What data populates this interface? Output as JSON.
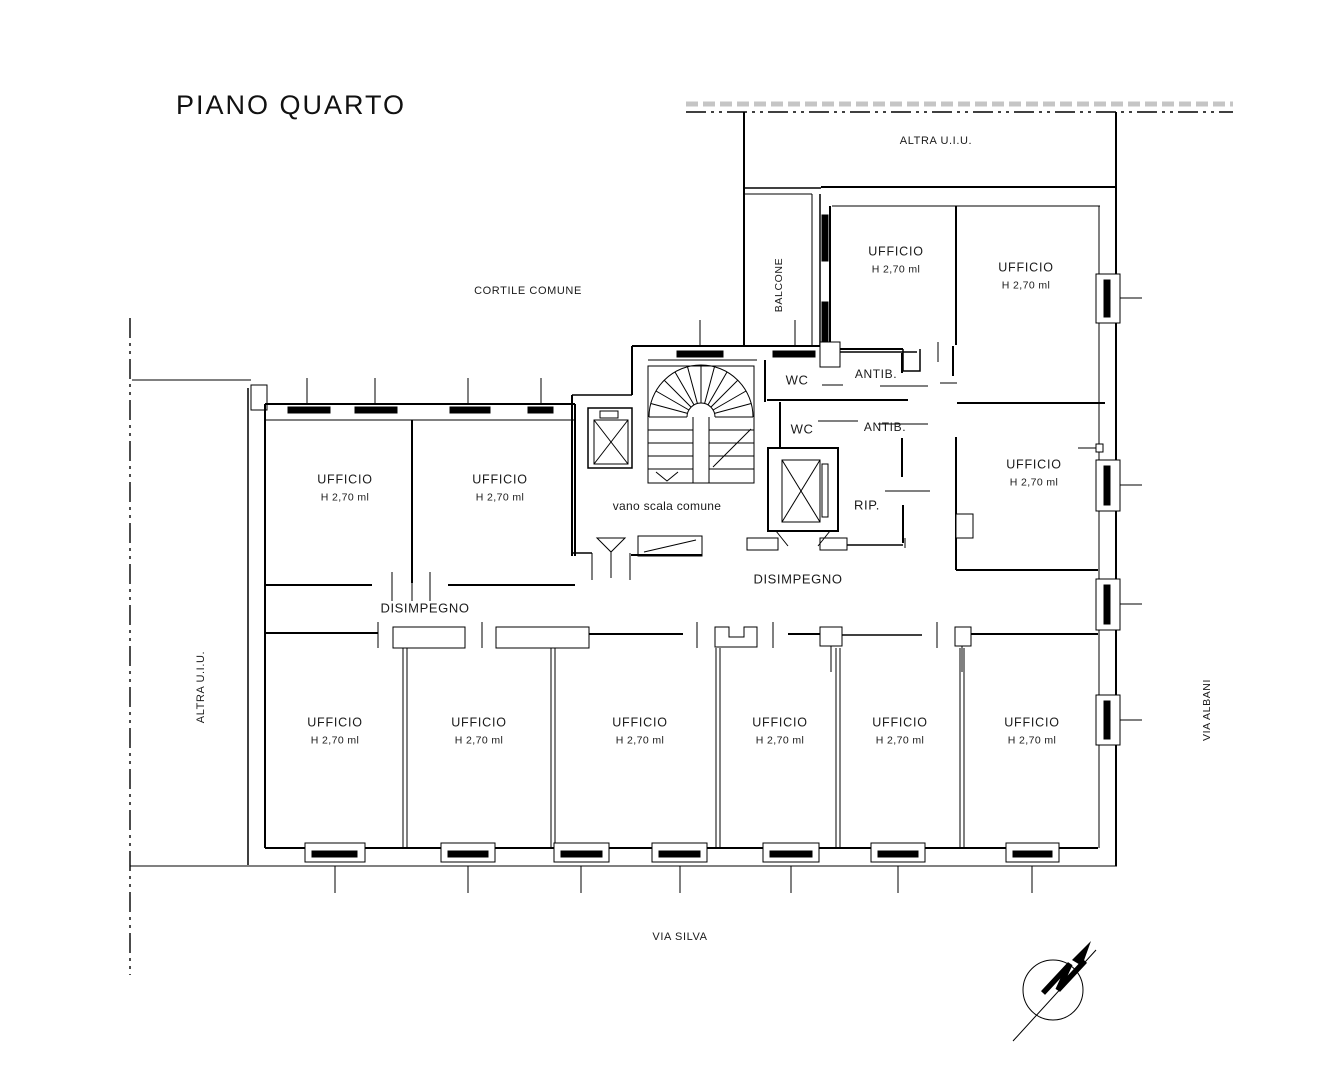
{
  "title": "PIANO QUARTO",
  "boundary_labels": {
    "altra_uiu_top": "ALTRA U.I.U.",
    "altra_uiu_left": "ALTRA U.I.U.",
    "cortile_comune": "CORTILE COMUNE",
    "via_silva": "VIA SILVA",
    "via_albani": "VIA ALBANI"
  },
  "core_labels": {
    "balcone": "BALCONE",
    "vano_scala": "vano scala comune",
    "wc_upper": "WC",
    "wc_lower": "WC",
    "antib_upper": "ANTIB.",
    "antib_lower": "ANTIB.",
    "rip": "RIP.",
    "disimpegno_main": "DISIMPEGNO",
    "disimpegno_left": "DISIMPEGNO"
  },
  "rooms": [
    {
      "label": "UFFICIO",
      "height": "H 2,70 ml"
    },
    {
      "label": "UFFICIO",
      "height": "H 2,70 ml"
    },
    {
      "label": "UFFICIO",
      "height": "H 2,70 ml"
    },
    {
      "label": "UFFICIO",
      "height": "H 2,70 ml"
    },
    {
      "label": "UFFICIO",
      "height": "H 2,70 ml"
    },
    {
      "label": "UFFICIO",
      "height": "H 2,70 ml"
    },
    {
      "label": "UFFICIO",
      "height": "H 2,70 ml"
    },
    {
      "label": "UFFICIO",
      "height": "H 2,70 ml"
    },
    {
      "label": "UFFICIO",
      "height": "H 2,70 ml"
    },
    {
      "label": "UFFICIO",
      "height": "H 2,70 ml"
    },
    {
      "label": "UFFICIO",
      "height": "H 2,70 ml"
    }
  ],
  "colors": {
    "line": "#000000",
    "hatch_gray": "#c5c5c5",
    "background": "#ffffff",
    "text": "#1a1a1a"
  }
}
